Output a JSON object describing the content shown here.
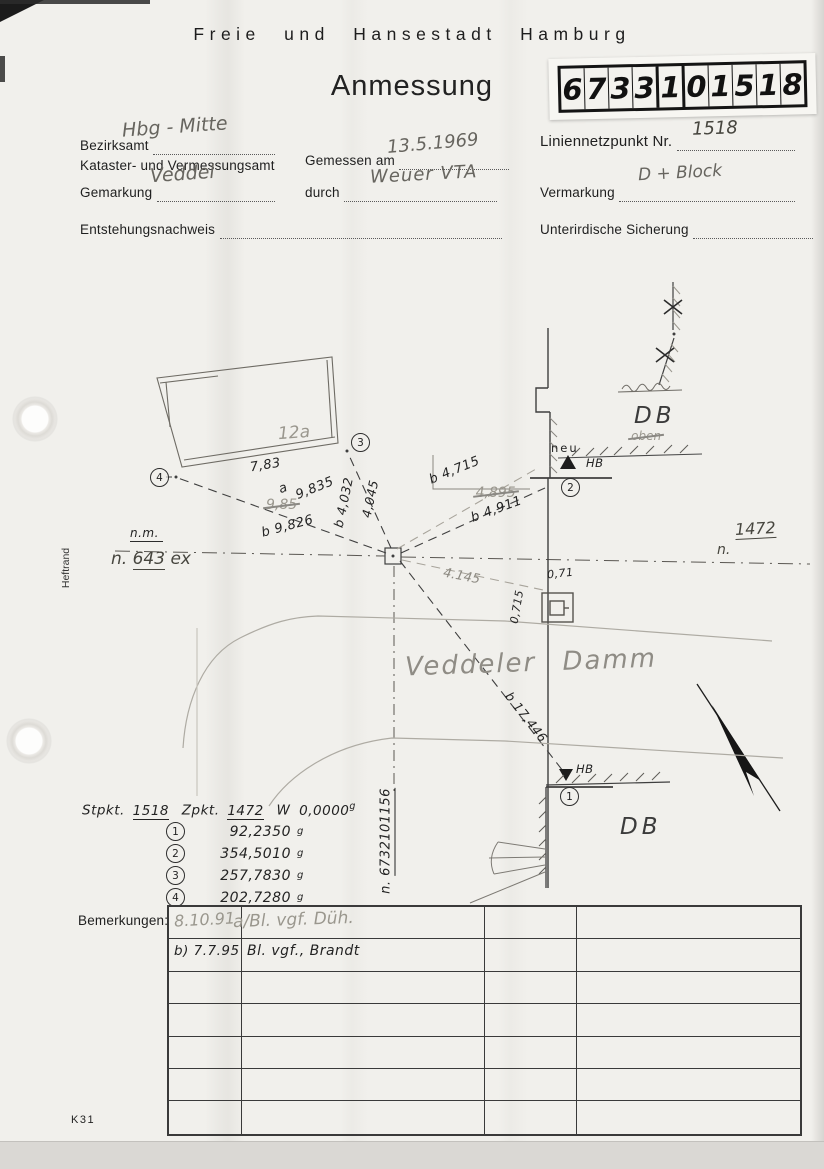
{
  "page": {
    "org": "Freie und Hansestadt Hamburg",
    "doc_title": "Anmessung",
    "sheet_number_cells": [
      "6",
      "7",
      "3",
      "3",
      "1",
      "0",
      "1",
      "5",
      "1",
      "8"
    ],
    "k_number": "K31",
    "heftrand": "Heftrand"
  },
  "form": {
    "bezirksamt_label": "Bezirksamt",
    "bezirksamt_value": "Hbg - Mitte",
    "kataster_label": "Kataster- und Vermessungsamt",
    "gemessen_label": "Gemessen am",
    "gemessen_value": "13.5.1969",
    "durch_label": "durch",
    "durch_value": "Weuer VTA",
    "liniennetzpunkt_label": "Liniennetzpunkt Nr.",
    "liniennetzpunkt_value": "1518",
    "gemarkung_label": "Gemarkung",
    "gemarkung_value": "Veddel",
    "vermarkung_label": "Vermarkung",
    "vermarkung_value": "D + Block",
    "entstehung_label": "Entstehungsnachweis",
    "sicherung_label": "Unterirdische Sicherung"
  },
  "sketch": {
    "building_label": "12a",
    "street_name": "Veddeler Damm",
    "db_top": "DB",
    "db_bottom": "DB",
    "neu": "neu",
    "oben_struck": "oben",
    "hb_top": "HB",
    "hb_bottom": "HB",
    "nm": "n.m.",
    "n643_prefix": "n.",
    "n643_value": "643",
    "n643_suffix": "ex",
    "n1472_prefix": "n.",
    "n1472_value": "1472",
    "n1382_struck": "1382",
    "n_vertical_prefix": "n.",
    "n_vertical_value": "6732101156",
    "points": {
      "p1": "1",
      "p2": "2",
      "p3": "3",
      "p4": "4"
    },
    "measurements": {
      "m783": "7,83",
      "a_label": "a",
      "m9835": "9,835",
      "m985_struck": "9,85",
      "mb9826": "b 9,826",
      "mb4032": "b 4,032",
      "m4045": "4,045",
      "mb4715": "b 4,715",
      "m4895_struck": "4,895",
      "mb4911": "b 4,911",
      "m4145": "4.145",
      "m071": "0,71",
      "m0715": "0,715",
      "mb17446": "b 17,446"
    }
  },
  "angles": {
    "stpkt_label": "Stpkt.",
    "stpkt_value": "1518",
    "zpkt_label": "Zpkt.",
    "zpkt_value": "1472",
    "w_label": "W",
    "w_value": "0,0000",
    "unit": "g",
    "rows": [
      {
        "no": "1",
        "value": "92,2350"
      },
      {
        "no": "2",
        "value": "354,5010"
      },
      {
        "no": "3",
        "value": "257,7830"
      },
      {
        "no": "4",
        "value": "202,7280"
      }
    ]
  },
  "bemerkungen": {
    "label": "Bemerkungen:",
    "rows": [
      {
        "date": "8.10.91",
        "text": "a/Bl. vgf. Düh."
      },
      {
        "date": "b) 7.7.95",
        "text": "Bl. vgf., Brandt"
      }
    ]
  }
}
